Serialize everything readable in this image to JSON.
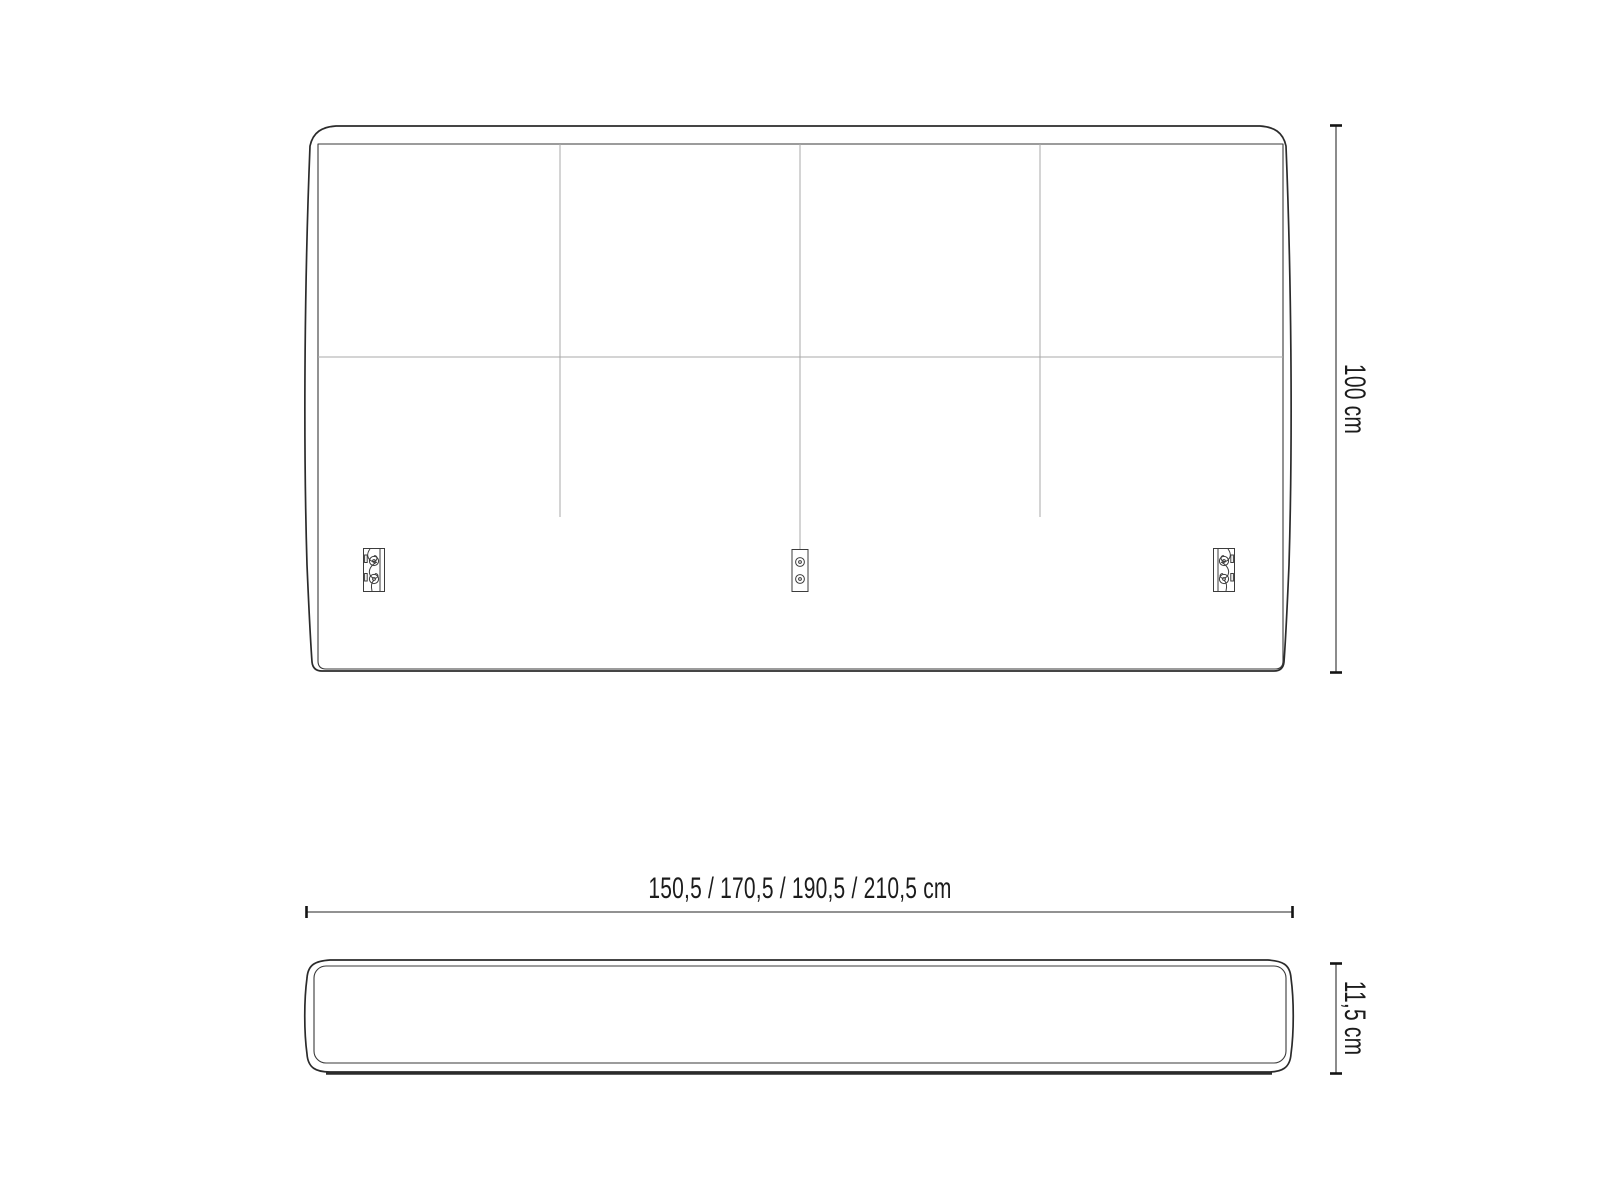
{
  "drawing": {
    "type": "furniture-technical-drawing",
    "subject": "upholstered headboard",
    "front_view": {
      "height_label": "100 cm",
      "width_label": "150,5 / 170,5 / 190,5 / 210,5 cm",
      "panel_count": 4,
      "bracket_count": 3
    },
    "side_view": {
      "depth_label": "11,5 cm"
    },
    "icons": {
      "mounting_bracket_left": "keyhole-bracket-icon",
      "mounting_bracket_center": "two-screw-plate-icon",
      "mounting_bracket_right": "keyhole-bracket-icon"
    },
    "colors": {
      "background": "#ffffff",
      "outline": "#2b2b2b",
      "inner_line": "#3a3a3a",
      "seam_line": "#a9a9a9",
      "dimension_line": "#6f6f6f",
      "tick": "#141414",
      "text": "#1c1c1c"
    }
  }
}
